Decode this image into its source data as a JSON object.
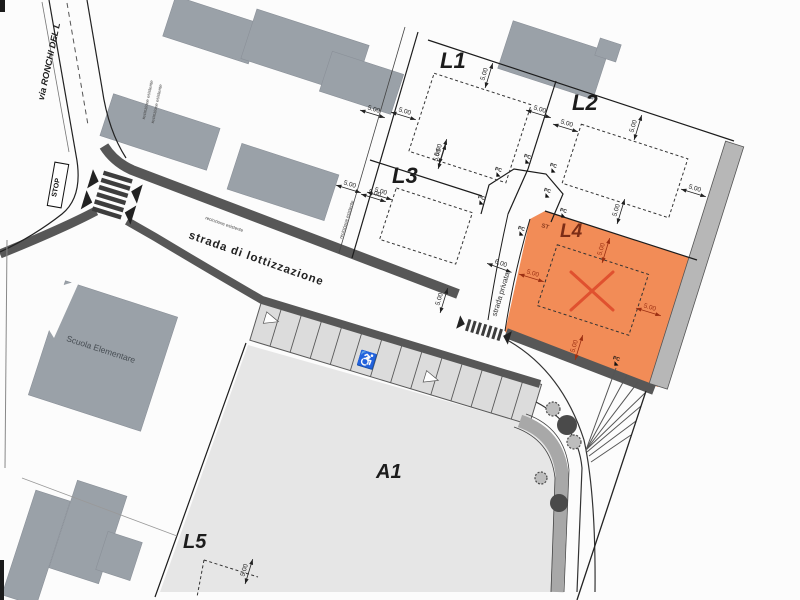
{
  "labels": {
    "via_ronchi": "via RONCHI DEL L",
    "stop": "STOP",
    "strada_lottizzazione": "strada di lottizzazione",
    "strada_privata": "strada privata",
    "scuola": "Scuola Elementare",
    "fence_note_1": "recinzione esistente",
    "fence_note_2": "recinzione esistente",
    "fence_note_3": "recinzione esistente",
    "fence_note_4": "recinzione esistente",
    "st_marker": "ST",
    "wheelchair_symbol": "♿"
  },
  "lots": {
    "l1": "L1",
    "l2": "L2",
    "l3": "L3",
    "l4": "L4",
    "l5": "L5",
    "a1": "A1"
  },
  "colors": {
    "lot_highlight": "#F28C57",
    "highlight_mark": "#E0512F",
    "building_gray": "#9aa1a8",
    "road_band": "#575757",
    "area_fill": "#e6e6e6",
    "tree_band": "#a8a8a8",
    "strip_gray": "#b7b7b7"
  },
  "dimensions": [
    {
      "label": "5.00",
      "x": 373,
      "y": 112,
      "r": 17
    },
    {
      "label": "5.00",
      "x": 404,
      "y": 114,
      "r": 17
    },
    {
      "label": "5.00",
      "x": 349,
      "y": 187,
      "r": 17
    },
    {
      "label": "5.00",
      "x": 380,
      "y": 194,
      "r": 17
    },
    {
      "label": "5.00",
      "x": 487,
      "y": 75,
      "r": -73
    },
    {
      "label": "5.00",
      "x": 441,
      "y": 151,
      "r": -73
    },
    {
      "label": "5.00",
      "x": 539,
      "y": 112,
      "r": 17
    },
    {
      "label": "5.00",
      "x": 566,
      "y": 126,
      "r": 17
    },
    {
      "label": "5.00",
      "x": 636,
      "y": 127,
      "r": -73
    },
    {
      "label": "5.00",
      "x": 694,
      "y": 191,
      "r": 17
    },
    {
      "label": "5.00",
      "x": 619,
      "y": 211,
      "r": -73
    },
    {
      "label": "5.00",
      "x": 374,
      "y": 196,
      "r": 17
    },
    {
      "label": "5.00",
      "x": 440,
      "y": 156,
      "r": -73
    },
    {
      "label": "5.00",
      "x": 442,
      "y": 300,
      "r": -73
    },
    {
      "label": "6.00",
      "x": 500,
      "y": 266,
      "r": 20
    },
    {
      "label": "5.00",
      "x": 604,
      "y": 250,
      "r": -73,
      "red": true
    },
    {
      "label": "5.00",
      "x": 532,
      "y": 276,
      "r": 17,
      "red": true
    },
    {
      "label": "5.00",
      "x": 649,
      "y": 310,
      "r": 17,
      "red": true
    },
    {
      "label": "5.00",
      "x": 577,
      "y": 347,
      "r": -73,
      "red": true
    },
    {
      "label": "5.00",
      "x": 247,
      "y": 571,
      "r": -73
    }
  ],
  "pc_markers": [
    {
      "label": "PC",
      "x": 498,
      "y": 171,
      "r": 17
    },
    {
      "label": "PC",
      "x": 527,
      "y": 158,
      "r": 17
    },
    {
      "label": "PC",
      "x": 553,
      "y": 167,
      "r": 17
    },
    {
      "label": "PC",
      "x": 481,
      "y": 199,
      "r": 17
    },
    {
      "label": "PC",
      "x": 547,
      "y": 192,
      "r": 17
    },
    {
      "label": "PC",
      "x": 563,
      "y": 212,
      "r": 17
    },
    {
      "label": "PC",
      "x": 521,
      "y": 230,
      "r": 17
    },
    {
      "label": "PC",
      "x": 616,
      "y": 360,
      "r": 17
    }
  ],
  "trees": [
    {
      "x": 553,
      "y": 409,
      "r": 7,
      "solid": false
    },
    {
      "x": 567,
      "y": 425,
      "r": 10,
      "solid": true
    },
    {
      "x": 574,
      "y": 442,
      "r": 7,
      "solid": false
    },
    {
      "x": 541,
      "y": 478,
      "r": 6,
      "solid": false
    },
    {
      "x": 559,
      "y": 503,
      "r": 9,
      "solid": true
    }
  ]
}
